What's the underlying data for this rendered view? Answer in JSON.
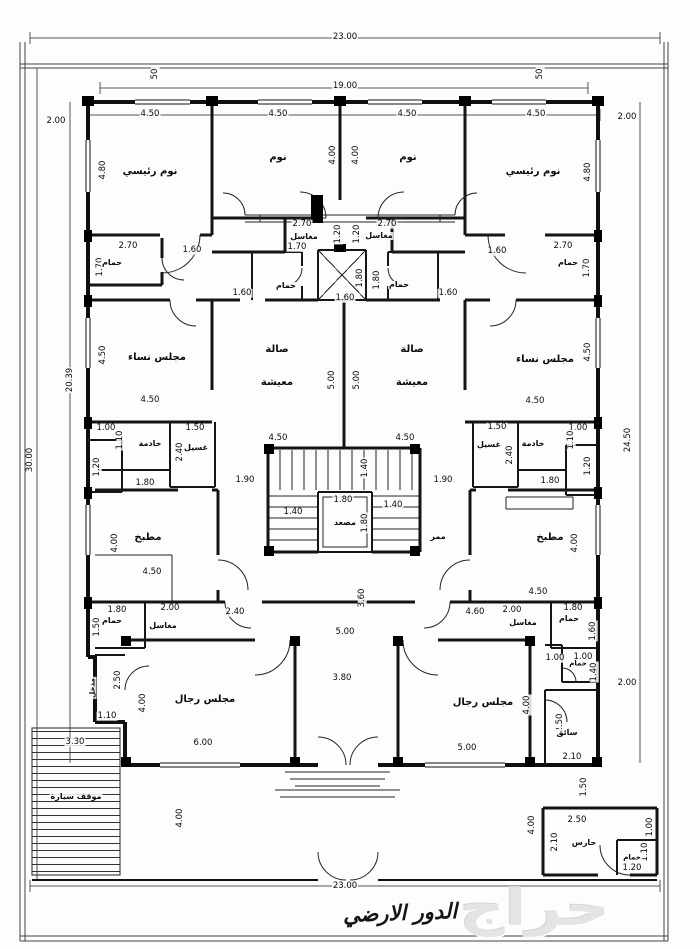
{
  "meta": {
    "drawing_title": "الدور الارضي",
    "watermark": "حراج",
    "line_color": "#111111",
    "paper_color": "#fdfdfd"
  },
  "plan": {
    "room_labels": [
      {
        "t": "نوم رئيسي",
        "x": 150,
        "y": 172
      },
      {
        "t": "نوم",
        "x": 278,
        "y": 158
      },
      {
        "t": "نوم",
        "x": 408,
        "y": 158
      },
      {
        "t": "نوم رئيسي",
        "x": 533,
        "y": 172
      },
      {
        "t": "مغاسل",
        "x": 304,
        "y": 237,
        "s": 8
      },
      {
        "t": "مغاسل",
        "x": 379,
        "y": 236,
        "s": 8
      },
      {
        "t": "حمام",
        "x": 112,
        "y": 263,
        "s": 8
      },
      {
        "t": "حمام",
        "x": 568,
        "y": 263,
        "s": 8
      },
      {
        "t": "حمام",
        "x": 286,
        "y": 286,
        "s": 8
      },
      {
        "t": "حمام",
        "x": 399,
        "y": 285,
        "s": 8
      },
      {
        "t": "مجلس نساء",
        "x": 157,
        "y": 358
      },
      {
        "t": "صالة",
        "x": 277,
        "y": 350
      },
      {
        "t": "معيشة",
        "x": 277,
        "y": 383
      },
      {
        "t": "صالة",
        "x": 412,
        "y": 350
      },
      {
        "t": "معيشة",
        "x": 412,
        "y": 383
      },
      {
        "t": "مجلس نساء",
        "x": 545,
        "y": 360
      },
      {
        "t": "خادمة",
        "x": 150,
        "y": 444,
        "s": 8
      },
      {
        "t": "غسيل",
        "x": 196,
        "y": 448,
        "s": 8
      },
      {
        "t": "غسيل",
        "x": 489,
        "y": 445,
        "s": 8
      },
      {
        "t": "خادمة",
        "x": 533,
        "y": 444,
        "s": 8
      },
      {
        "t": "مصعد",
        "x": 345,
        "y": 523,
        "s": 8
      },
      {
        "t": "ممر",
        "x": 438,
        "y": 537,
        "s": 8
      },
      {
        "t": "مطبخ",
        "x": 148,
        "y": 538
      },
      {
        "t": "مطبخ",
        "x": 550,
        "y": 538
      },
      {
        "t": "حمام",
        "x": 112,
        "y": 621,
        "s": 8
      },
      {
        "t": "مغاسل",
        "x": 163,
        "y": 626,
        "s": 8
      },
      {
        "t": "مغاسل",
        "x": 523,
        "y": 623,
        "s": 8
      },
      {
        "t": "حمام",
        "x": 569,
        "y": 619,
        "s": 8
      },
      {
        "t": "مجلس رجال",
        "x": 205,
        "y": 700
      },
      {
        "t": "مجلس رجال",
        "x": 483,
        "y": 703
      },
      {
        "t": "حمام",
        "x": 578,
        "y": 664,
        "s": 7
      },
      {
        "t": "سائق",
        "x": 567,
        "y": 733,
        "s": 8
      },
      {
        "t": "مدخل",
        "x": 93,
        "y": 688,
        "s": 7,
        "r": 1
      },
      {
        "t": "موقف سيارة",
        "x": 76,
        "y": 797,
        "s": 8
      },
      {
        "t": "حارس",
        "x": 584,
        "y": 843,
        "s": 8
      },
      {
        "t": "حمام",
        "x": 632,
        "y": 858,
        "s": 7
      }
    ],
    "dim_labels": [
      {
        "t": "23.00",
        "x": 345,
        "y": 37
      },
      {
        "t": "19.00",
        "x": 345,
        "y": 86
      },
      {
        "t": "50",
        "x": 155,
        "y": 74,
        "r": 1
      },
      {
        "t": "50",
        "x": 540,
        "y": 74,
        "r": 1
      },
      {
        "t": "2.00",
        "x": 56,
        "y": 121
      },
      {
        "t": "2.00",
        "x": 627,
        "y": 117
      },
      {
        "t": "4.50",
        "x": 150,
        "y": 114
      },
      {
        "t": "4.50",
        "x": 278,
        "y": 114
      },
      {
        "t": "4.50",
        "x": 407,
        "y": 114
      },
      {
        "t": "4.50",
        "x": 536,
        "y": 114
      },
      {
        "t": "4.80",
        "x": 103,
        "y": 170,
        "r": 1
      },
      {
        "t": "4.00",
        "x": 333,
        "y": 155,
        "r": 1
      },
      {
        "t": "4.00",
        "x": 356,
        "y": 155,
        "r": 1
      },
      {
        "t": "4.80",
        "x": 588,
        "y": 172,
        "r": 1
      },
      {
        "t": "2.70",
        "x": 302,
        "y": 224
      },
      {
        "t": "2.70",
        "x": 387,
        "y": 224
      },
      {
        "t": "1.20",
        "x": 338,
        "y": 234,
        "r": 1
      },
      {
        "t": "1.20",
        "x": 357,
        "y": 234,
        "r": 1
      },
      {
        "t": "1.70",
        "x": 297,
        "y": 247
      },
      {
        "t": "2.70",
        "x": 128,
        "y": 246
      },
      {
        "t": "1.70",
        "x": 100,
        "y": 267,
        "r": 1
      },
      {
        "t": "1.60",
        "x": 192,
        "y": 250
      },
      {
        "t": "2.70",
        "x": 563,
        "y": 246
      },
      {
        "t": "1.70",
        "x": 587,
        "y": 268,
        "r": 1
      },
      {
        "t": "1.60",
        "x": 497,
        "y": 251
      },
      {
        "t": "1.60",
        "x": 242,
        "y": 293
      },
      {
        "t": "1.60",
        "x": 345,
        "y": 298
      },
      {
        "t": "1.60",
        "x": 448,
        "y": 293
      },
      {
        "t": "1.80",
        "x": 360,
        "y": 278,
        "r": 1
      },
      {
        "t": "1.80",
        "x": 377,
        "y": 280,
        "r": 1
      },
      {
        "t": "20.39",
        "x": 70,
        "y": 380,
        "r": 1
      },
      {
        "t": "30.00",
        "x": 30,
        "y": 460,
        "r": 1
      },
      {
        "t": "24.50",
        "x": 628,
        "y": 440,
        "r": 1
      },
      {
        "t": "4.50",
        "x": 103,
        "y": 355,
        "r": 1
      },
      {
        "t": "4.50",
        "x": 150,
        "y": 400
      },
      {
        "t": "4.50",
        "x": 588,
        "y": 352,
        "r": 1
      },
      {
        "t": "4.50",
        "x": 535,
        "y": 401
      },
      {
        "t": "5.00",
        "x": 332,
        "y": 380,
        "r": 1
      },
      {
        "t": "5.00",
        "x": 357,
        "y": 380,
        "r": 1
      },
      {
        "t": "1.00",
        "x": 106,
        "y": 428
      },
      {
        "t": "1.10",
        "x": 120,
        "y": 440,
        "r": 1
      },
      {
        "t": "1.50",
        "x": 195,
        "y": 428
      },
      {
        "t": "2.40",
        "x": 180,
        "y": 452,
        "r": 1
      },
      {
        "t": "1.20",
        "x": 97,
        "y": 467,
        "r": 1
      },
      {
        "t": "1.80",
        "x": 145,
        "y": 483
      },
      {
        "t": "1.90",
        "x": 245,
        "y": 480
      },
      {
        "t": "1.50",
        "x": 497,
        "y": 427
      },
      {
        "t": "1.00",
        "x": 578,
        "y": 428
      },
      {
        "t": "1.10",
        "x": 571,
        "y": 440,
        "r": 1
      },
      {
        "t": "2.40",
        "x": 510,
        "y": 455,
        "r": 1
      },
      {
        "t": "1.20",
        "x": 588,
        "y": 466,
        "r": 1
      },
      {
        "t": "1.80",
        "x": 550,
        "y": 481
      },
      {
        "t": "1.90",
        "x": 443,
        "y": 480
      },
      {
        "t": "4.50",
        "x": 278,
        "y": 438
      },
      {
        "t": "4.50",
        "x": 405,
        "y": 438
      },
      {
        "t": "1.40",
        "x": 365,
        "y": 468,
        "r": 1
      },
      {
        "t": "1.80",
        "x": 343,
        "y": 500
      },
      {
        "t": "1.40",
        "x": 293,
        "y": 512
      },
      {
        "t": "1.40",
        "x": 393,
        "y": 505
      },
      {
        "t": "1.80",
        "x": 365,
        "y": 523,
        "r": 1
      },
      {
        "t": "4.00",
        "x": 115,
        "y": 543,
        "r": 1
      },
      {
        "t": "4.50",
        "x": 152,
        "y": 572
      },
      {
        "t": "4.00",
        "x": 575,
        "y": 543,
        "r": 1
      },
      {
        "t": "4.50",
        "x": 538,
        "y": 592
      },
      {
        "t": "3.60",
        "x": 362,
        "y": 598,
        "r": 1
      },
      {
        "t": "1.80",
        "x": 117,
        "y": 610
      },
      {
        "t": "2.00",
        "x": 170,
        "y": 608
      },
      {
        "t": "2.40",
        "x": 235,
        "y": 612
      },
      {
        "t": "1.50",
        "x": 97,
        "y": 627,
        "r": 1
      },
      {
        "t": "4.60",
        "x": 475,
        "y": 612
      },
      {
        "t": "2.00",
        "x": 512,
        "y": 610
      },
      {
        "t": "1.80",
        "x": 573,
        "y": 608
      },
      {
        "t": "1.60",
        "x": 593,
        "y": 631,
        "r": 1
      },
      {
        "t": "5.00",
        "x": 345,
        "y": 632
      },
      {
        "t": "3.80",
        "x": 342,
        "y": 678
      },
      {
        "t": "2.00",
        "x": 627,
        "y": 683
      },
      {
        "t": "2.50",
        "x": 118,
        "y": 680,
        "r": 1
      },
      {
        "t": "1.10",
        "x": 107,
        "y": 716
      },
      {
        "t": "4.00",
        "x": 143,
        "y": 703,
        "r": 1
      },
      {
        "t": "6.00",
        "x": 203,
        "y": 743
      },
      {
        "t": "1.00",
        "x": 555,
        "y": 658
      },
      {
        "t": "1.00",
        "x": 583,
        "y": 657
      },
      {
        "t": "1.40",
        "x": 594,
        "y": 672,
        "r": 1
      },
      {
        "t": "4.00",
        "x": 527,
        "y": 705,
        "r": 1
      },
      {
        "t": "5.00",
        "x": 467,
        "y": 748
      },
      {
        "t": "2.50",
        "x": 560,
        "y": 723,
        "r": 1
      },
      {
        "t": "2.10",
        "x": 572,
        "y": 757
      },
      {
        "t": "3.30",
        "x": 75,
        "y": 742
      },
      {
        "t": "4.00",
        "x": 180,
        "y": 818,
        "r": 1
      },
      {
        "t": "1.50",
        "x": 584,
        "y": 787,
        "r": 1
      },
      {
        "t": "4.00",
        "x": 532,
        "y": 825,
        "r": 1
      },
      {
        "t": "2.50",
        "x": 577,
        "y": 820
      },
      {
        "t": "2.10",
        "x": 555,
        "y": 842,
        "r": 1
      },
      {
        "t": "1.00",
        "x": 650,
        "y": 827,
        "r": 1
      },
      {
        "t": "1.10",
        "x": 645,
        "y": 852,
        "r": 1
      },
      {
        "t": "1.20",
        "x": 632,
        "y": 868
      },
      {
        "t": "23.00",
        "x": 345,
        "y": 886
      }
    ]
  }
}
